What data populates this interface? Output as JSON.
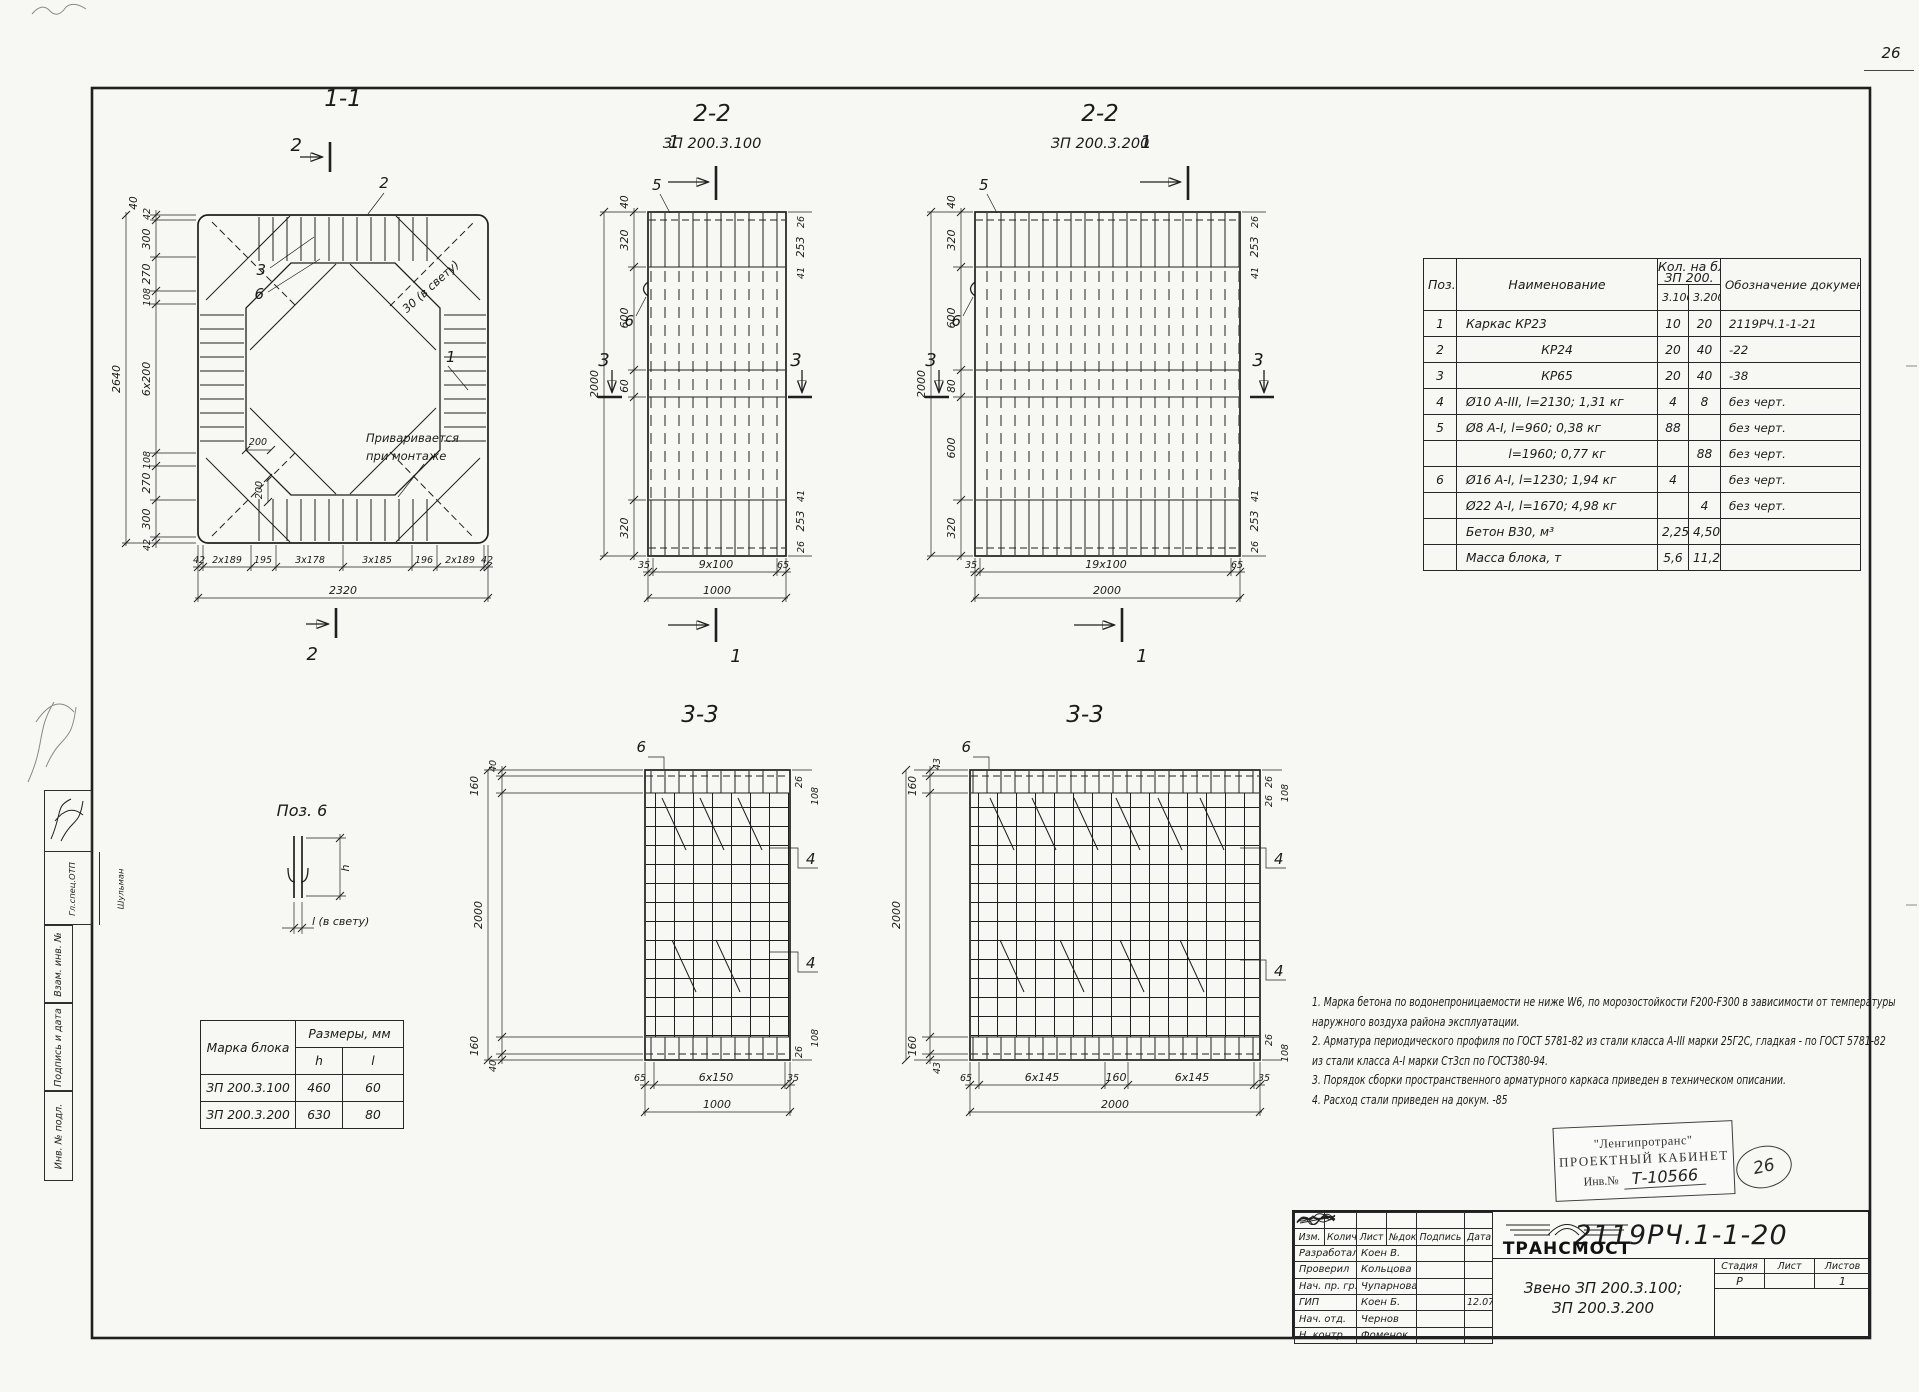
{
  "page": {
    "number": "26"
  },
  "margin": {
    "chief": "Гл.спец.ОТП",
    "chief_name": "Шульман",
    "vzam": "Взам. инв. №",
    "podpis": "Подпись и дата",
    "inv": "Инв. № подл."
  },
  "s11": {
    "title": "1-1",
    "cut": "2",
    "c1": "1",
    "c2": "2",
    "c3": "3",
    "c6": "6",
    "clear": "30 (в свету)",
    "weld1": "Приваривается",
    "weld2": "при монтаже",
    "dim40": "40",
    "left": [
      "42",
      "300",
      "270",
      "108",
      "6x200",
      "108",
      "270",
      "300",
      "42"
    ],
    "total_left": "2640",
    "bottom": [
      "42",
      "2x189",
      "195",
      "3x178",
      "3x185",
      "196",
      "2x189",
      "42"
    ],
    "total_bottom": "2320",
    "dim200a": "200",
    "dim200b": "200"
  },
  "s22a": {
    "title": "2-2",
    "subtitle": "ЗП 200.3.100",
    "cut1": "1",
    "cut3": "3",
    "c5": "5",
    "c6": "6",
    "left": [
      "40",
      "320",
      "600",
      "60",
      "320"
    ],
    "total_left": "2000",
    "right_top": [
      "26",
      "253",
      "41"
    ],
    "right_bottom": [
      "41",
      "253",
      "26"
    ],
    "bottom": [
      "35",
      "9x100",
      "65"
    ],
    "total_bottom": "1000"
  },
  "s22b": {
    "title": "2-2",
    "subtitle": "ЗП 200.3.200",
    "cut1": "1",
    "cut3": "3",
    "c5": "5",
    "c6": "6",
    "left": [
      "40",
      "320",
      "600",
      "80",
      "600",
      "320"
    ],
    "total_left": "2000",
    "right_top": [
      "26",
      "253",
      "41"
    ],
    "right_bottom": [
      "41",
      "253",
      "26"
    ],
    "bottom": [
      "35",
      "19x100",
      "65"
    ],
    "total_bottom": "2000"
  },
  "s33a": {
    "title": "3-3",
    "c4": "4",
    "c6": "6",
    "left_top": [
      "40",
      "160"
    ],
    "left_bottom": [
      "160",
      "40"
    ],
    "total_left": "2000",
    "right_top": [
      "26",
      "108"
    ],
    "right_bottom": [
      "108",
      "26"
    ],
    "bottom": [
      "65",
      "6x150",
      "35"
    ],
    "total_bottom": "1000"
  },
  "s33b": {
    "title": "3-3",
    "c4": "4",
    "c6": "6",
    "left_top": [
      "43",
      "160"
    ],
    "left_bottom": [
      "160",
      "43"
    ],
    "total_left": "2000",
    "right_top": [
      "26",
      "26",
      "108"
    ],
    "right_bottom": [
      "26",
      "108"
    ],
    "bottom": [
      "65",
      "6x145",
      "160",
      "6x145",
      "35"
    ],
    "total_bottom": "2000"
  },
  "pos6": {
    "title": "Поз. 6",
    "h": "h",
    "l": "l (в свету)"
  },
  "blocks_table": {
    "mark_header": "Марка блока",
    "size_header": "Размеры, мм",
    "h": "h",
    "l": "l",
    "rows": [
      {
        "mark": "ЗП 200.3.100",
        "h": "460",
        "l": "60"
      },
      {
        "mark": "ЗП 200.3.200",
        "h": "630",
        "l": "80"
      }
    ]
  },
  "spec_table": {
    "poz": "Поз.",
    "name": "Наименование",
    "qty1": "Кол. на блок",
    "qty2": "ЗП 200.",
    "c1": "3.100",
    "c2": "3.200",
    "doc": "Обозначение документа",
    "rows": [
      {
        "poz": "1",
        "name": "Каркас КР23",
        "q1": "10",
        "q2": "20",
        "doc": "2119РЧ.1-1-21"
      },
      {
        "poz": "2",
        "name": "КР24",
        "q1": "20",
        "q2": "40",
        "doc": "-22"
      },
      {
        "poz": "3",
        "name": "КР65",
        "q1": "20",
        "q2": "40",
        "doc": "-38"
      },
      {
        "poz": "4",
        "name": "Ø10 А-III, l=2130; 1,31 кг",
        "q1": "4",
        "q2": "8",
        "doc": "без черт."
      },
      {
        "poz": "5",
        "name": "Ø8 А-I, l=960; 0,38 кг",
        "q1": "88",
        "q2": "",
        "doc": "без черт."
      },
      {
        "poz": "",
        "name": "l=1960; 0,77 кг",
        "q1": "",
        "q2": "88",
        "doc": "без черт."
      },
      {
        "poz": "6",
        "name": "Ø16 А-I, l=1230; 1,94 кг",
        "q1": "4",
        "q2": "",
        "doc": "без черт."
      },
      {
        "poz": "",
        "name": "Ø22 А-I, l=1670; 4,98 кг",
        "q1": "",
        "q2": "4",
        "doc": "без черт."
      },
      {
        "poz": "",
        "name": "Бетон В30, м³",
        "q1": "2,25",
        "q2": "4,50",
        "doc": ""
      },
      {
        "poz": "",
        "name": "Масса блока, т",
        "q1": "5,6",
        "q2": "11,2",
        "doc": ""
      }
    ]
  },
  "notes": {
    "l1": "1. Марка бетона по водонепроницаемости не ниже W6, по морозостойкости F200-F300 в зависимости от температуры",
    "l2": "наружного воздуха района эксплуатации.",
    "l3": "2. Арматура периодического профиля по ГОСТ 5781-82 из стали класса А-III марки 25Г2С, гладкая - по ГОСТ 5781-82",
    "l4": "из стали класса А-I марки Ст3сп по ГОСТ380-94.",
    "l5": "3. Порядок сборки пространственного арматурного каркаса приведен в техническом описании.",
    "l6": "4. Расход стали приведен на докум. -85"
  },
  "stamp": {
    "org": "\"Ленгипротранс\"",
    "office": "ПРОЕКТНЫЙ КАБИНЕТ",
    "inv_label": "Инв.№",
    "inv_value": "Т-10566",
    "circle": "26"
  },
  "titleblock": {
    "doc": "2119РЧ.1-1-20",
    "subject1": "Звено ЗП 200.3.100;",
    "subject2": "ЗП 200.3.200",
    "stage_label": "Стадия",
    "sheet_label": "Лист",
    "sheets_label": "Листов",
    "stage": "Р",
    "sheet": "",
    "sheets": "1",
    "logo": "ТРАНСМОСТ",
    "cols": [
      "Изм.",
      "Колич.",
      "Лист",
      "№док.",
      "Подпись",
      "Дата"
    ],
    "rows": [
      {
        "role": "Разработал",
        "name": "Коен В.",
        "date": ""
      },
      {
        "role": "Проверил",
        "name": "Кольцова",
        "date": ""
      },
      {
        "role": "Нач. пр. гр.",
        "name": "Чупарнова",
        "date": ""
      },
      {
        "role": "ГИП",
        "name": "Коен Б.",
        "date": "12.07"
      },
      {
        "role": "Нач. отд.",
        "name": "Чернов",
        "date": ""
      },
      {
        "role": "Н. контр.",
        "name": "Фоменок",
        "date": ""
      }
    ]
  }
}
